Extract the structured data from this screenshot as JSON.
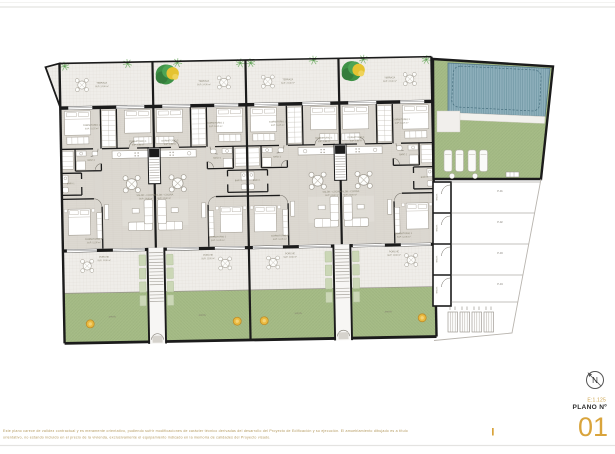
{
  "page": {
    "bg": "#ffffff",
    "rule_color": "#e4e3e1"
  },
  "title_block": {
    "north": "N",
    "scale": "E:1.125",
    "plano_label": "PLANO Nº",
    "plano_number": "01",
    "accent": "#d9a43c"
  },
  "disclaimer": {
    "line1": "Este plano carece de validez contractual y es meramente orientativo, pudiendo sufrir modificaciones de carácter técnico derivadas del desarrollo del Proyecto de Edificación y su ejecución. El amueblamiento dibujado es a título",
    "line2": "orientativo, no estando incluido en el precio de la vivienda, exclusivamente el equipamiento indicado en la memoria de calidades del Proyecto visado."
  },
  "plan": {
    "labels": {
      "terraza": "TERRAZA",
      "terraza_sup": "SUP: 24,30 m²",
      "dorm2": "DORMITORIO 2",
      "dorm2_sup": "SUP: 10,25 m²",
      "dorm3": "DORMITORIO 3",
      "dorm3_sup": "SUP: 9,80 m²",
      "banyo1": "BAÑO 1",
      "banyo2": "BAÑO 2",
      "salon": "SALÓN - COCINA",
      "salon_sup": "SUP: 24,60 m²",
      "dorm1": "DORMITORIO 1",
      "dorm1_sup": "SUP: 12,35 m²",
      "porche": "PORCHE",
      "porche_sup": "SUP: 11,50 m²",
      "jardin": "JARDÍN",
      "trastero": "TRAST."
    },
    "parking": {
      "spaces": [
        "P-01",
        "P-02",
        "P-03",
        "P-04"
      ]
    },
    "colors": {
      "wall": "#1b1b1b",
      "floor": "#dcd8d1",
      "tile": "#efede9",
      "garden": "#a6bc87",
      "pool": "#8fb0bc",
      "planter": "#cbd7b6",
      "tree_green": "#3f9247",
      "tree_yellow": "#e5c331",
      "marker": "#e9b93f"
    }
  }
}
